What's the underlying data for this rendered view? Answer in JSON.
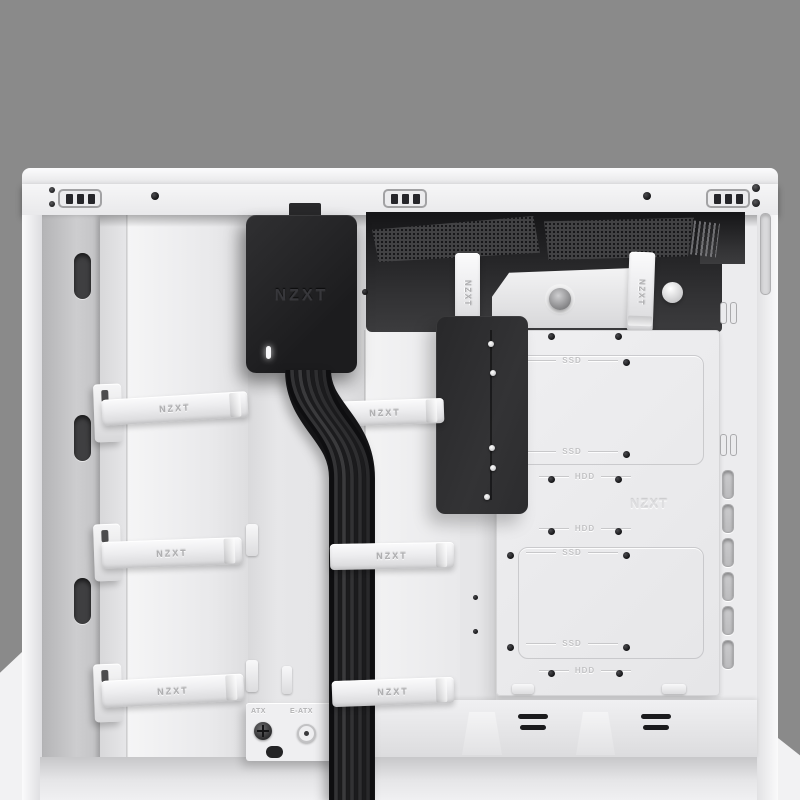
{
  "colors": {
    "backdrop": "#8a8a8a",
    "case_white": "#ececee",
    "recess_panel_gray": "#c2c2c4",
    "component_black": "#232325",
    "cavity_dark": "#2a2a2c",
    "strap_white": "#ececee",
    "etched_label_gray": "#c3c3c5",
    "embossed_logo_gray": "#dedee0"
  },
  "hub": {
    "logo": "NZXT"
  },
  "straps": {
    "label": "NZXT"
  },
  "drive_tray": {
    "brand_logo": "NZXT",
    "upper": {
      "ssd_top": "SSD",
      "ssd_bottom": "SSD",
      "hdd": "HDD"
    },
    "lower": {
      "hdd_top": "HDD",
      "ssd_top": "SSD",
      "ssd_bottom": "SSD",
      "hdd_bottom": "HDD"
    }
  },
  "standoff_labels": {
    "atx": "ATX",
    "eatx": "E-ATX"
  }
}
